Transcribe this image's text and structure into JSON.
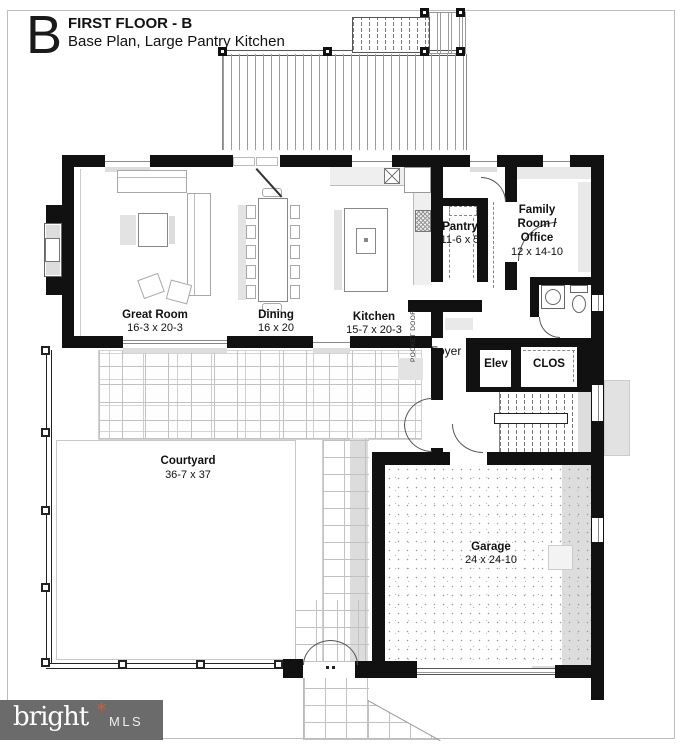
{
  "title": {
    "letter": "B",
    "line1": "FIRST FLOOR - B",
    "line2": "Base Plan, Large Pantry Kitchen"
  },
  "rooms": {
    "great_room": {
      "name": "Great Room",
      "dims": "16-3 x 20-3"
    },
    "dining": {
      "name": "Dining",
      "dims": "16 x 20"
    },
    "kitchen": {
      "name": "Kitchen",
      "dims": "15-7 x 20-3"
    },
    "pantry": {
      "name": "Pantry",
      "dims": "11-6 x 5"
    },
    "family_room": {
      "line1": "Family",
      "line2": "Room /",
      "line3": "Office",
      "dims": "12 x 14-10"
    },
    "foyer": {
      "name": "Foyer"
    },
    "elevator": {
      "name": "Elev"
    },
    "closet": {
      "name": "CLOS"
    },
    "courtyard": {
      "name": "Courtyard",
      "dims": "36-7 x 37"
    },
    "garage": {
      "name": "Garage",
      "dims": "24 x 24-10"
    }
  },
  "annotations": {
    "pocket_door": "POCKET DOOR"
  },
  "logo": {
    "brand": "bright",
    "star": "*",
    "suffix": "MLS"
  },
  "colors": {
    "wall": "#111111",
    "logo_bg": "#6b6b6b",
    "logo_star": "#d95b2a",
    "line": "#555555"
  }
}
